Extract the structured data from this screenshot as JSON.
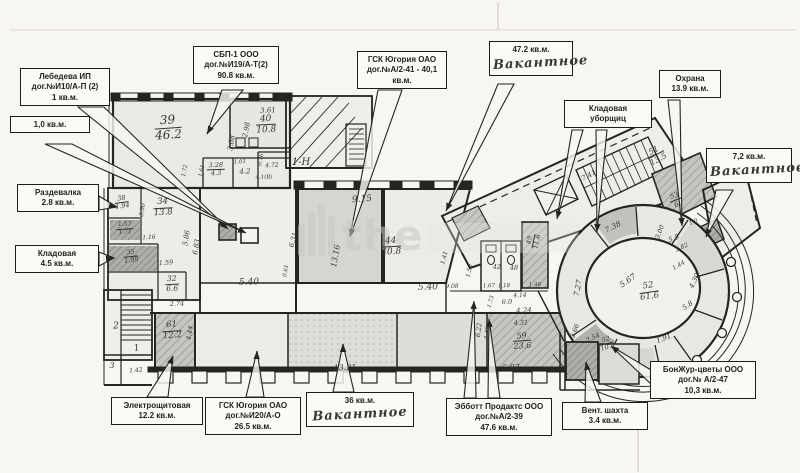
{
  "plan": {
    "type": "floor-plan-scan",
    "watermark": {
      "text": "the",
      "bar_heights": [
        34,
        46,
        54,
        42
      ]
    },
    "colors": {
      "ink": "#26241f",
      "paper": "#f7f6f2",
      "gray_room": "#c6c5c0",
      "dark_room": "#b0afaa",
      "light_room": "#ecebe6",
      "watermark": "#c9c7c1"
    },
    "callouts": [
      {
        "id": "sbp1",
        "lines": [
          "СБП-1 ООО",
          "дог.№И19/А-Т(2)",
          "90.8 кв.м."
        ],
        "x": 193,
        "y": 46,
        "w": 86,
        "leaders": [
          [
            222,
            90,
            243,
            90,
            207,
            134
          ]
        ]
      },
      {
        "id": "lebedeva",
        "lines": [
          "Лебедева ИП",
          "дог.№И10/А-П (2)",
          "1 кв.м."
        ],
        "x": 20,
        "y": 68,
        "w": 90,
        "leaders": [
          [
            78,
            107,
            104,
            107,
            228,
            229
          ]
        ]
      },
      {
        "id": "v10",
        "lines": [
          "1,0 кв.м."
        ],
        "x": 10,
        "y": 116,
        "w": 80,
        "leaders": [
          [
            45,
            144,
            72,
            144,
            246,
            233
          ]
        ]
      },
      {
        "id": "razdevalka",
        "lines": [
          "Раздевалка",
          "2.8 кв.м."
        ],
        "x": 17,
        "y": 184,
        "w": 82,
        "leaders": [
          [
            99,
            196,
            99,
            210,
            117,
            207
          ]
        ]
      },
      {
        "id": "kladovaya45",
        "lines": [
          "Кладовая",
          "4.5 кв.м."
        ],
        "x": 15,
        "y": 245,
        "w": 84,
        "leaders": [
          [
            99,
            252,
            99,
            266,
            114,
            258
          ]
        ]
      },
      {
        "id": "gsk41",
        "lines": [
          "ГСК Югория ОАО",
          "дог.№А/2-41 -  40,1",
          "кв.м."
        ],
        "x": 357,
        "y": 51,
        "w": 90,
        "leaders": [
          [
            378,
            90,
            402,
            90,
            350,
            237
          ]
        ]
      },
      {
        "id": "v472",
        "lines": [
          "47.2 кв.м."
        ],
        "handwritten": "Вакантное",
        "x": 489,
        "y": 41,
        "w": 84,
        "leaders": [
          [
            498,
            84,
            514,
            84,
            446,
            211
          ]
        ]
      },
      {
        "id": "klad_ub",
        "lines": [
          "Кладовая",
          "уборщиц"
        ],
        "x": 564,
        "y": 100,
        "w": 88,
        "leaders": [
          [
            572,
            130,
            583,
            130,
            557,
            219
          ],
          [
            596,
            130,
            607,
            130,
            597,
            232
          ]
        ]
      },
      {
        "id": "ohrana",
        "lines": [
          "Охрана",
          "13.9 кв.м."
        ],
        "x": 659,
        "y": 70,
        "w": 62,
        "leaders": [
          [
            668,
            100,
            680,
            100,
            682,
            226
          ]
        ]
      },
      {
        "id": "v72",
        "lines": [
          "7,2 кв.м."
        ],
        "handwritten": "Вакантное",
        "x": 706,
        "y": 148,
        "w": 86,
        "leaders": [
          [
            716,
            190,
            733,
            190,
            706,
            237
          ]
        ]
      },
      {
        "id": "elektro",
        "lines": [
          "Электрощитовая",
          "12.2 кв.м."
        ],
        "x": 111,
        "y": 397,
        "w": 92,
        "leaders": [
          [
            147,
            397,
            168,
            397,
            173,
            356
          ]
        ]
      },
      {
        "id": "gsk20",
        "lines": [
          "ГСК Югория ОАО",
          "дог.№И20/А-О",
          "26.5 кв.м."
        ],
        "x": 205,
        "y": 397,
        "w": 96,
        "leaders": [
          [
            246,
            397,
            264,
            397,
            257,
            351
          ]
        ]
      },
      {
        "id": "v36",
        "lines": [
          "36 кв.м."
        ],
        "handwritten": "Вакантное",
        "x": 306,
        "y": 392,
        "w": 108,
        "leaders": [
          [
            333,
            392,
            354,
            392,
            343,
            344
          ]
        ]
      },
      {
        "id": "abbott",
        "lines": [
          "Эбботт Продактс ООО",
          "дог.№А/2-39",
          "47.6 кв.м."
        ],
        "x": 446,
        "y": 398,
        "w": 106,
        "leaders": [
          [
            464,
            398,
            476,
            398,
            474,
            301
          ],
          [
            488,
            398,
            500,
            398,
            489,
            319
          ]
        ]
      },
      {
        "id": "vent",
        "lines": [
          "Вент. шахта",
          "3.4 кв.м."
        ],
        "x": 562,
        "y": 402,
        "w": 86,
        "leaders": [
          [
            585,
            402,
            601,
            402,
            586,
            362
          ]
        ]
      },
      {
        "id": "bonjour",
        "lines": [
          "БонЖур-цветы ООО",
          "дог.№ А/2-47",
          "10,3 кв.м."
        ],
        "x": 650,
        "y": 361,
        "w": 106,
        "leaders": [
          [
            651,
            370,
            651,
            384,
            611,
            346
          ]
        ]
      }
    ],
    "room_labels": [
      [
        "39",
        "46.2",
        168,
        128,
        -4,
        12
      ],
      [
        "40",
        "10.8",
        266,
        125,
        -3,
        9
      ],
      [
        "3.28",
        "4.3",
        216,
        170,
        -2,
        6.5
      ],
      [
        "34",
        "13.8",
        163,
        208,
        -3,
        8.5
      ],
      [
        "38",
        "1.94",
        122,
        203,
        -8,
        6.5
      ],
      [
        "1.57",
        "1.71",
        125,
        229,
        -4,
        6
      ],
      [
        "35",
        "1.99",
        131,
        257,
        -6,
        6.5
      ],
      [
        "32",
        "6.6",
        172,
        284,
        -3,
        7.5
      ],
      [
        "61",
        "12.2",
        172,
        331,
        -4,
        8.5
      ],
      [
        "44",
        "40.8",
        391,
        247,
        -3,
        9
      ],
      [
        "59",
        "23.6",
        522,
        341,
        -4,
        8
      ],
      [
        "51",
        "13.5",
        656,
        155,
        -28,
        8
      ],
      [
        "53",
        "6.",
        676,
        200,
        -22,
        7
      ],
      [
        "49",
        "11.6",
        534,
        241,
        -78,
        6.5
      ],
      [
        "52",
        "61.6",
        649,
        292,
        -8,
        8.5
      ],
      [
        "52",
        "10.3",
        607,
        344,
        -15,
        6.5
      ]
    ],
    "dimension_labels": [
      [
        "1-Н",
        301,
        163,
        0,
        10
      ],
      [
        "3.61",
        268,
        111,
        -3,
        7
      ],
      [
        "2.98",
        247,
        130,
        -78,
        7
      ],
      [
        "3.08",
        232,
        143,
        -80,
        7
      ],
      [
        "4.2",
        245,
        172,
        -2,
        7
      ],
      [
        "1.01",
        240,
        163,
        -2,
        5.5
      ],
      [
        "0.76",
        262,
        160,
        -78,
        5.5
      ],
      [
        "4.72",
        272,
        166,
        -2,
        6
      ],
      [
        "4.1(В)",
        264,
        178,
        0,
        5.5
      ],
      [
        "1.61",
        203,
        171,
        -78,
        5.5
      ],
      [
        "1.72",
        186,
        171,
        -78,
        5.5
      ],
      [
        "9.15",
        362,
        200,
        -4,
        9
      ],
      [
        "13.16",
        336,
        256,
        -80,
        8
      ],
      [
        "6.31",
        294,
        240,
        -75,
        7
      ],
      [
        "5.86",
        187,
        238,
        -80,
        7
      ],
      [
        "6.83",
        197,
        247,
        -80,
        7
      ],
      [
        "1.59",
        166,
        263,
        -3,
        6.5
      ],
      [
        "1.16",
        149,
        238,
        -3,
        6
      ],
      [
        "3.90",
        143,
        210,
        -80,
        6
      ],
      [
        "5.40",
        249,
        283,
        -2,
        9
      ],
      [
        "5.40",
        428,
        288,
        -2,
        9
      ],
      [
        "0.61",
        287,
        271,
        -80,
        5.5
      ],
      [
        "2.74",
        177,
        304,
        -2,
        6.5
      ],
      [
        "4.44",
        190,
        333,
        -80,
        6.5
      ],
      [
        "13.21",
        345,
        368,
        -2,
        8
      ],
      [
        "5.92",
        511,
        368,
        -3,
        8
      ],
      [
        "4.24",
        524,
        311,
        -3,
        7
      ],
      [
        "4.31",
        521,
        323,
        -3,
        6.5
      ],
      [
        "6.0",
        507,
        302,
        -2,
        6.5
      ],
      [
        "4.14",
        520,
        296,
        -2,
        6
      ],
      [
        "6.22",
        479,
        330,
        -83,
        6.5
      ],
      [
        "4.42",
        488,
        333,
        -83,
        6
      ],
      [
        "1.73",
        492,
        302,
        -75,
        5.5
      ],
      [
        "1.67",
        489,
        287,
        -2,
        5.5
      ],
      [
        "1.18",
        504,
        287,
        -2,
        5.5
      ],
      [
        "1.48",
        535,
        286,
        -2,
        5.5
      ],
      [
        "1.41",
        445,
        258,
        -75,
        6
      ],
      [
        "9.08",
        452,
        287,
        -2,
        6
      ],
      [
        "1.50",
        470,
        271,
        -78,
        6
      ],
      [
        "42",
        497,
        267,
        -2,
        6.5
      ],
      [
        "48",
        514,
        268,
        -2,
        6.5
      ],
      [
        "7.38",
        613,
        227,
        -28,
        7.5
      ],
      [
        "7.41",
        589,
        176,
        -28,
        7
      ],
      [
        "7.27",
        578,
        288,
        -80,
        7.5
      ],
      [
        "5.67",
        628,
        281,
        -35,
        8
      ],
      [
        "5.8",
        688,
        306,
        -35,
        7
      ],
      [
        "4.30",
        695,
        281,
        -65,
        7
      ],
      [
        "1.44",
        679,
        266,
        -30,
        6
      ],
      [
        "1.91",
        664,
        339,
        -22,
        7
      ],
      [
        "2.66",
        575,
        331,
        -70,
        6.5
      ],
      [
        "2.54",
        593,
        338,
        -25,
        6.5
      ],
      [
        "3.00",
        660,
        232,
        -70,
        6.5
      ],
      [
        "5.5",
        674,
        239,
        -20,
        7
      ],
      [
        "2.82",
        682,
        248,
        -25,
        6
      ],
      [
        "1.0",
        694,
        223,
        -25,
        5.5
      ],
      [
        "2",
        116,
        327,
        0,
        9
      ],
      [
        "1",
        137,
        349,
        -10,
        9
      ],
      [
        "3",
        112,
        366,
        0,
        8
      ],
      [
        "1.42",
        136,
        371,
        -5,
        6
      ]
    ]
  }
}
